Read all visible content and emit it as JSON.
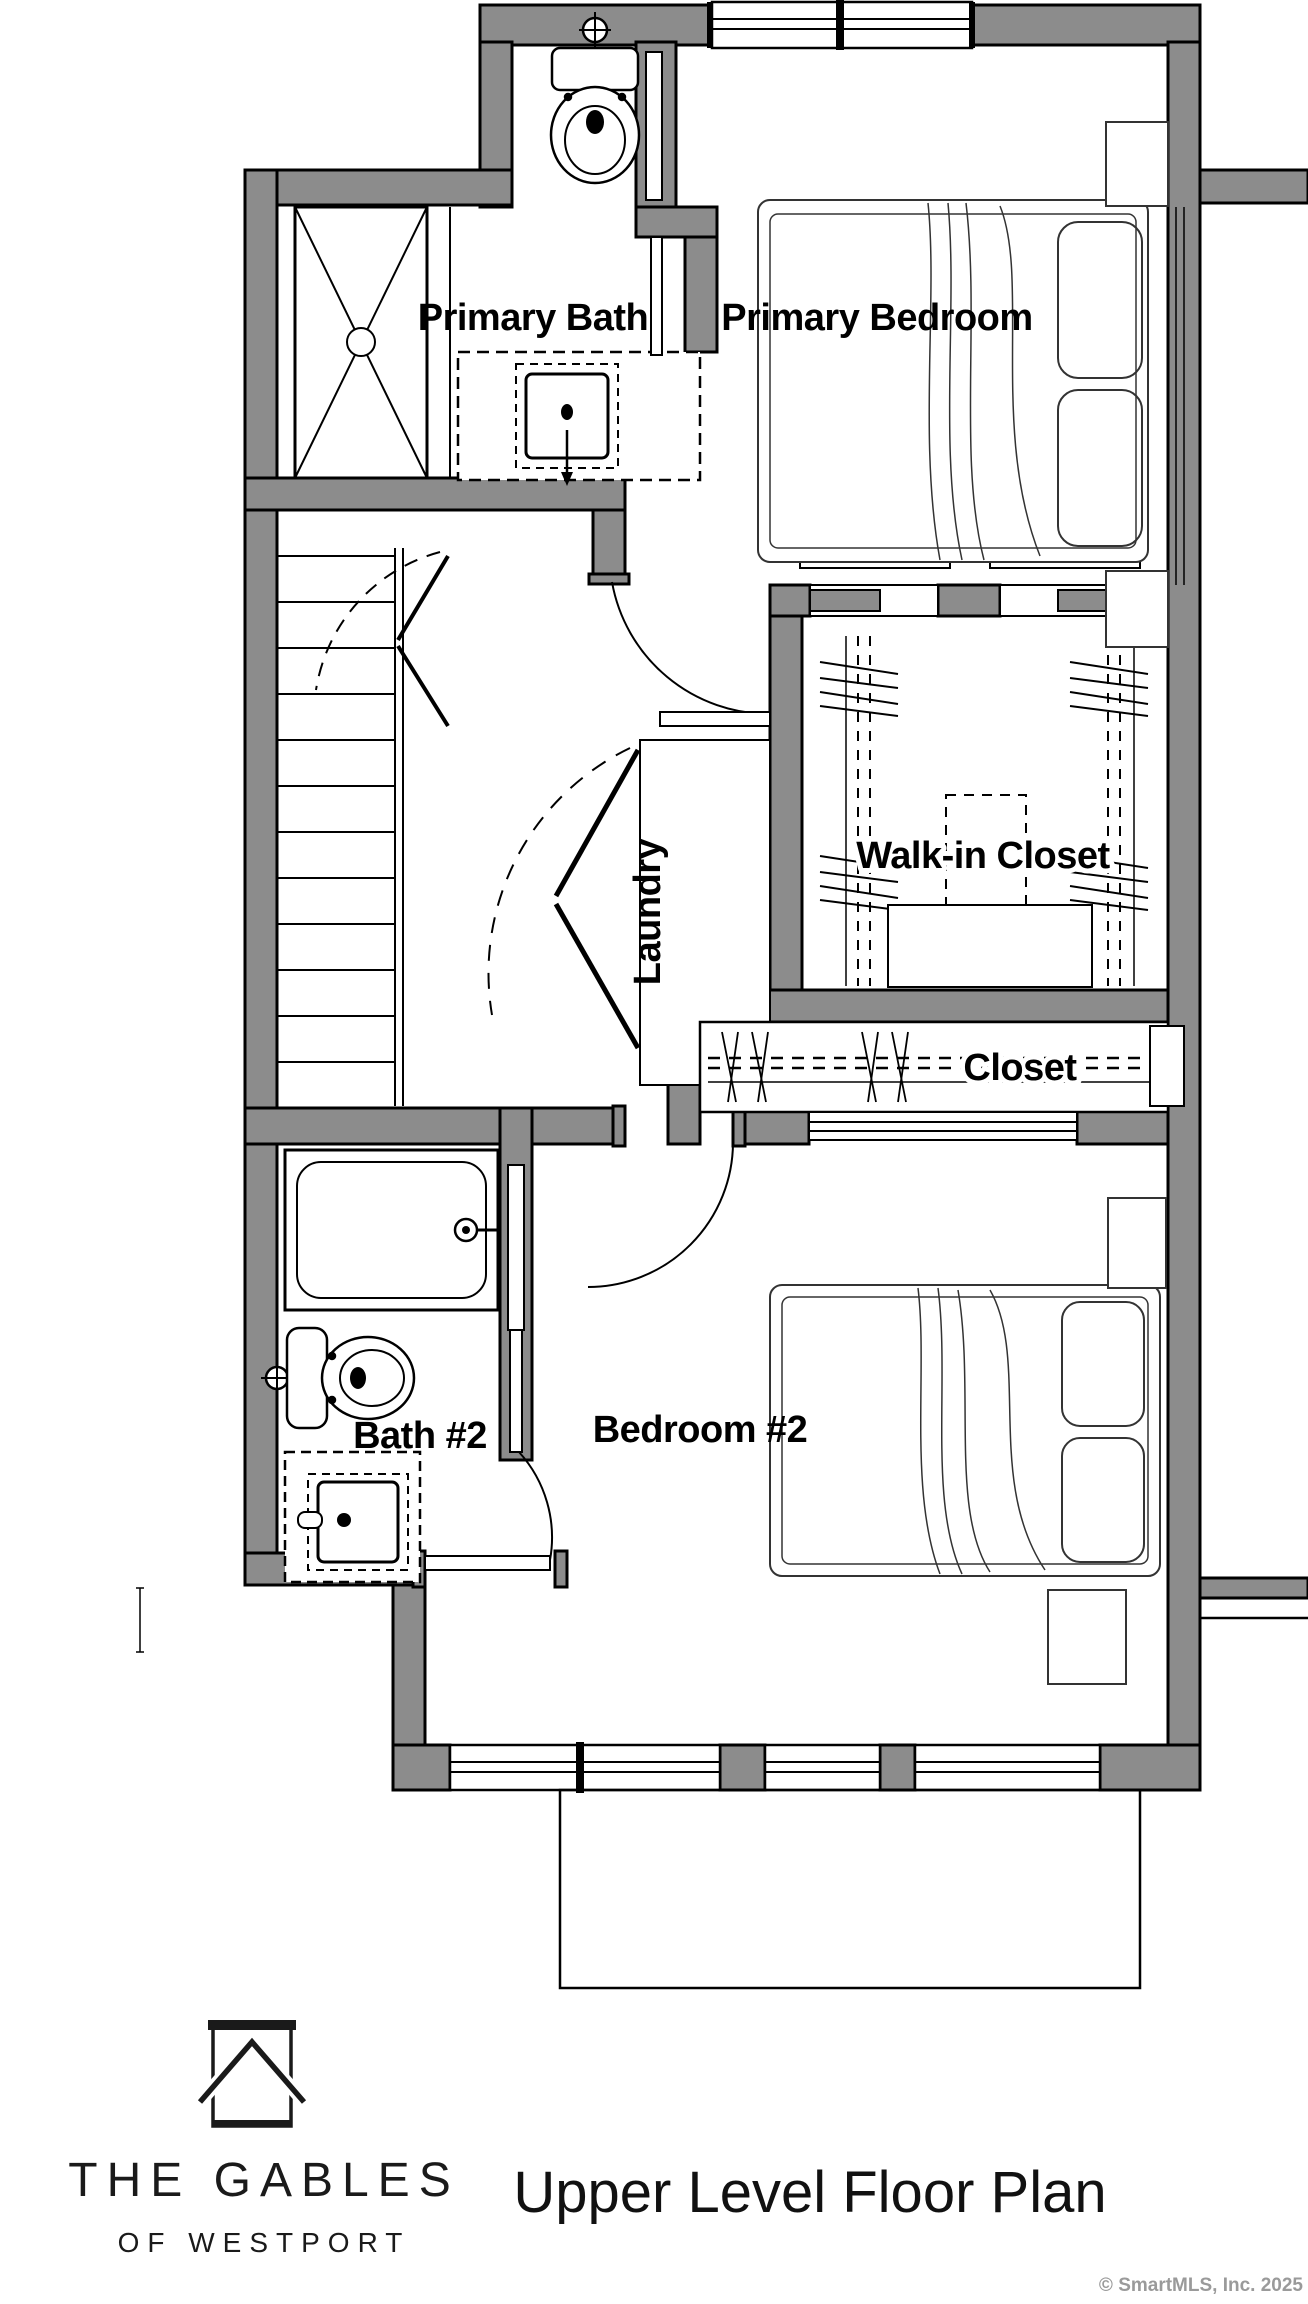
{
  "plan": {
    "labels": {
      "primary_bath": "Primary Bath",
      "primary_bedroom": "Primary Bedroom",
      "walk_in_closet": "Walk-in Closet",
      "laundry": "Laundry",
      "closet": "Closet",
      "bath_2": "Bath #2",
      "bedroom_2": "Bedroom #2"
    }
  },
  "footer": {
    "brand_line1": "THE GABLES",
    "brand_line2": "OF WESTPORT",
    "title": "Upper Level Floor Plan"
  },
  "copyright": "© SmartMLS, Inc.  2025",
  "colors": {
    "wall": "#8c8c8c",
    "line": "#000000",
    "muted": "#9a9a9a"
  }
}
